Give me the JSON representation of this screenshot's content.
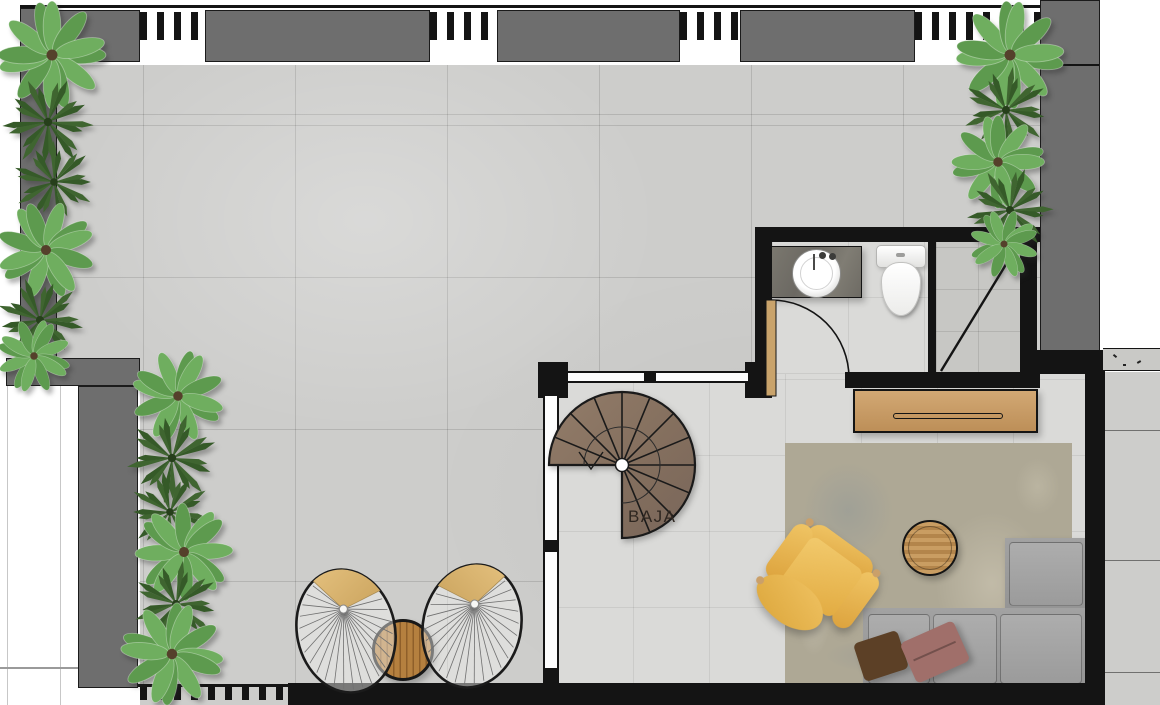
{
  "plan": {
    "stair": {
      "label": "BAJA"
    }
  },
  "palette": {
    "wall-gray": "#6e6e6e",
    "wall-black": "#141414",
    "terrace-tile": "#cdcdcb",
    "interior-tile": "#dadad8",
    "shower-tile": "#c7c7c4",
    "wood-console": "#c49a66",
    "wood-stair": "#86715f",
    "wood-table": "#b5803f",
    "wood-door": "#c9a36b",
    "rug-beige": "#aea895",
    "sofa-gray": "#9d9d9d",
    "armchair-yellow": "#e6b24c",
    "cushion-tan": "#ddbd82",
    "plant-light": "#6fae5f",
    "plant-dark": "#3f6530",
    "pouf-brown": "#5c4026",
    "pouf-mauve": "#a06f6a",
    "counter-marble": "#75726b",
    "fixture-white": "#fbfbfb"
  },
  "icons": [
    "spiral-staircase",
    "washbasin",
    "toilet",
    "shower",
    "hinged-door",
    "glass-window",
    "console-table",
    "area-rug",
    "round-coffee-table",
    "sectional-sofa",
    "lounge-armchair",
    "pouf",
    "fan-wire-chair",
    "patio-slat-table",
    "fern-plant",
    "palm-plant"
  ]
}
